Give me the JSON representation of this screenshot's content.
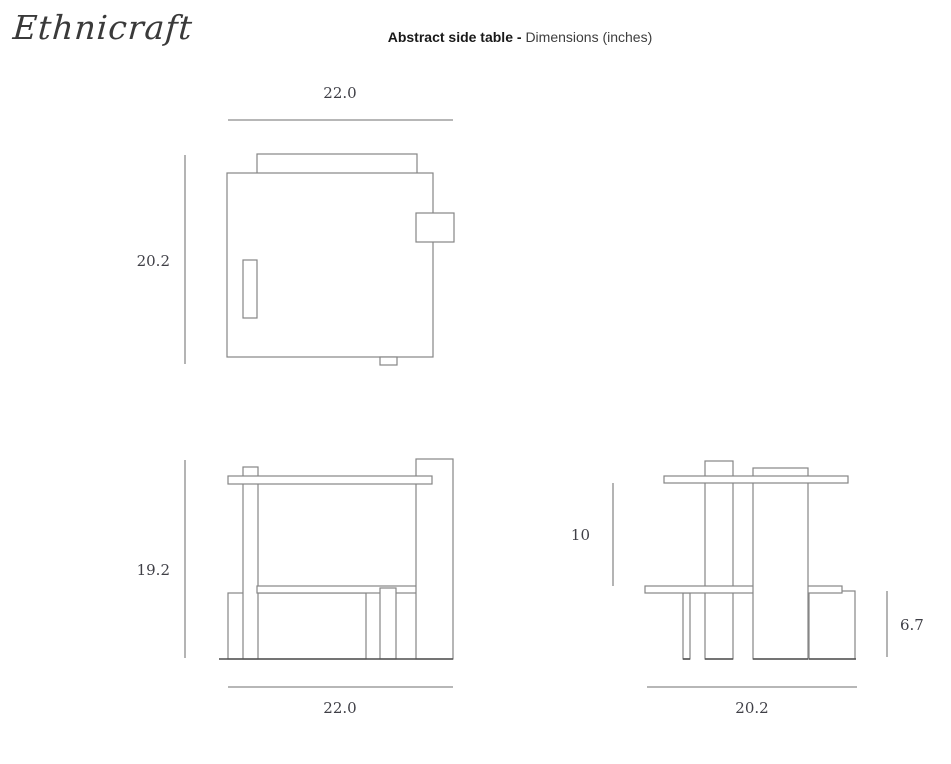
{
  "brand": {
    "logo_text": "Ethnicraft"
  },
  "header": {
    "title_bold": "Abstract side table -",
    "title_regular": "Dimensions (inches)",
    "units": "inches"
  },
  "views": {
    "top": {
      "label": "top view",
      "width_label": "22.0",
      "depth_label": "20.2"
    },
    "front": {
      "label": "front view",
      "height_label": "19.2",
      "width_label": "22.0"
    },
    "side": {
      "label": "side view",
      "upper_height_label": "10",
      "box_height_label": "6.7",
      "depth_label": "20.2"
    }
  },
  "colors": {
    "outline": "#868686",
    "dimension_line": "#8c8c8c",
    "baseline": "#4f4f4f",
    "label_text": "#3f3f46",
    "title_bold_text": "#191919",
    "title_regular_text": "#3e3e3e",
    "logo_text": "#3a3a3a",
    "background": "#ffffff"
  }
}
